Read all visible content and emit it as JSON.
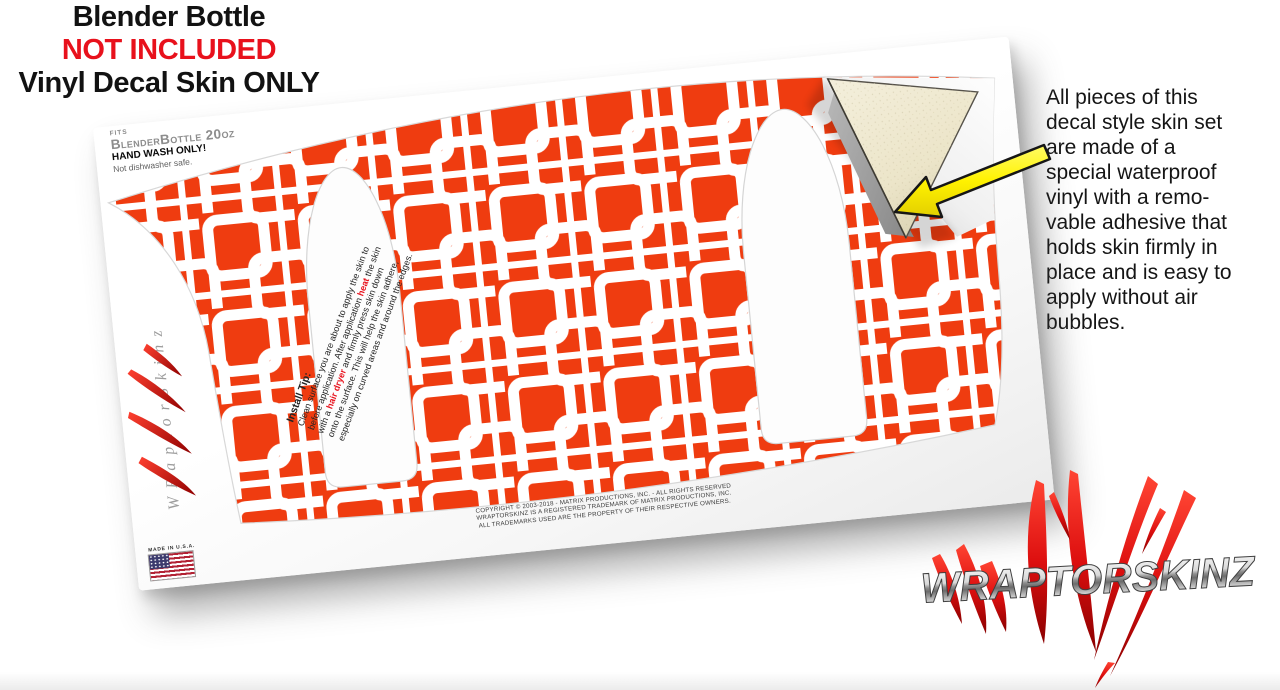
{
  "header": {
    "line1": "Blender Bottle",
    "line2": "NOT INCLUDED",
    "line3": "Vinyl Decal Skin ONLY"
  },
  "info_panel": {
    "lines": [
      "All pieces of this",
      "decal style  skin set",
      "are made of a",
      "special waterproof",
      "vinyl with a remo-",
      "vable adhesive that",
      "holds skin firmly in",
      "place and is easy to",
      "apply without air",
      "bubbles."
    ]
  },
  "sheet": {
    "fits_label": "FITS",
    "product": "BlenderBottle 20oz",
    "hand_wash": "HAND WASH ONLY!",
    "dishwasher": "Not dishwasher safe.",
    "made_in": "MADE IN U.S.A.",
    "install_tip": {
      "title": "Install Tip:",
      "line1": "Clean surface you are about to apply the skin to",
      "line2_pre": "before application. After application ",
      "line2_hl": "heat",
      "line2_post": " the skin",
      "line3_pre": "with a ",
      "line3_hl": "hair dryer",
      "line3_post": " and firmly press skin down",
      "line4": "onto the surface. This will help the skin adhere,",
      "line5": "especially on curved areas and around the edges."
    },
    "copyright": [
      "COPYRIGHT © 2003-2018 - MATRIX PRODUCTIONS, INC. - ALL RIGHTS RESERVED",
      "WRAPTORSKINZ IS A REGISTERED TRADEMARK OF MATRIX PRODUCTIONS, INC.",
      "ALL TRADEMARKS USED ARE THE PROPERTY OF THEIR RESPECTIVE OWNERS."
    ]
  },
  "brand": {
    "wordmark": "WRAPTORSKINZ",
    "watermark": "WRaptorSkinz"
  },
  "colors": {
    "pattern_orange": "#ef3c10",
    "highlight_red": "#e8111c",
    "arrow_yellow": "#fff200",
    "backing_cream": "#efe9d2",
    "adhesive_gray": "#9b9b9b"
  }
}
